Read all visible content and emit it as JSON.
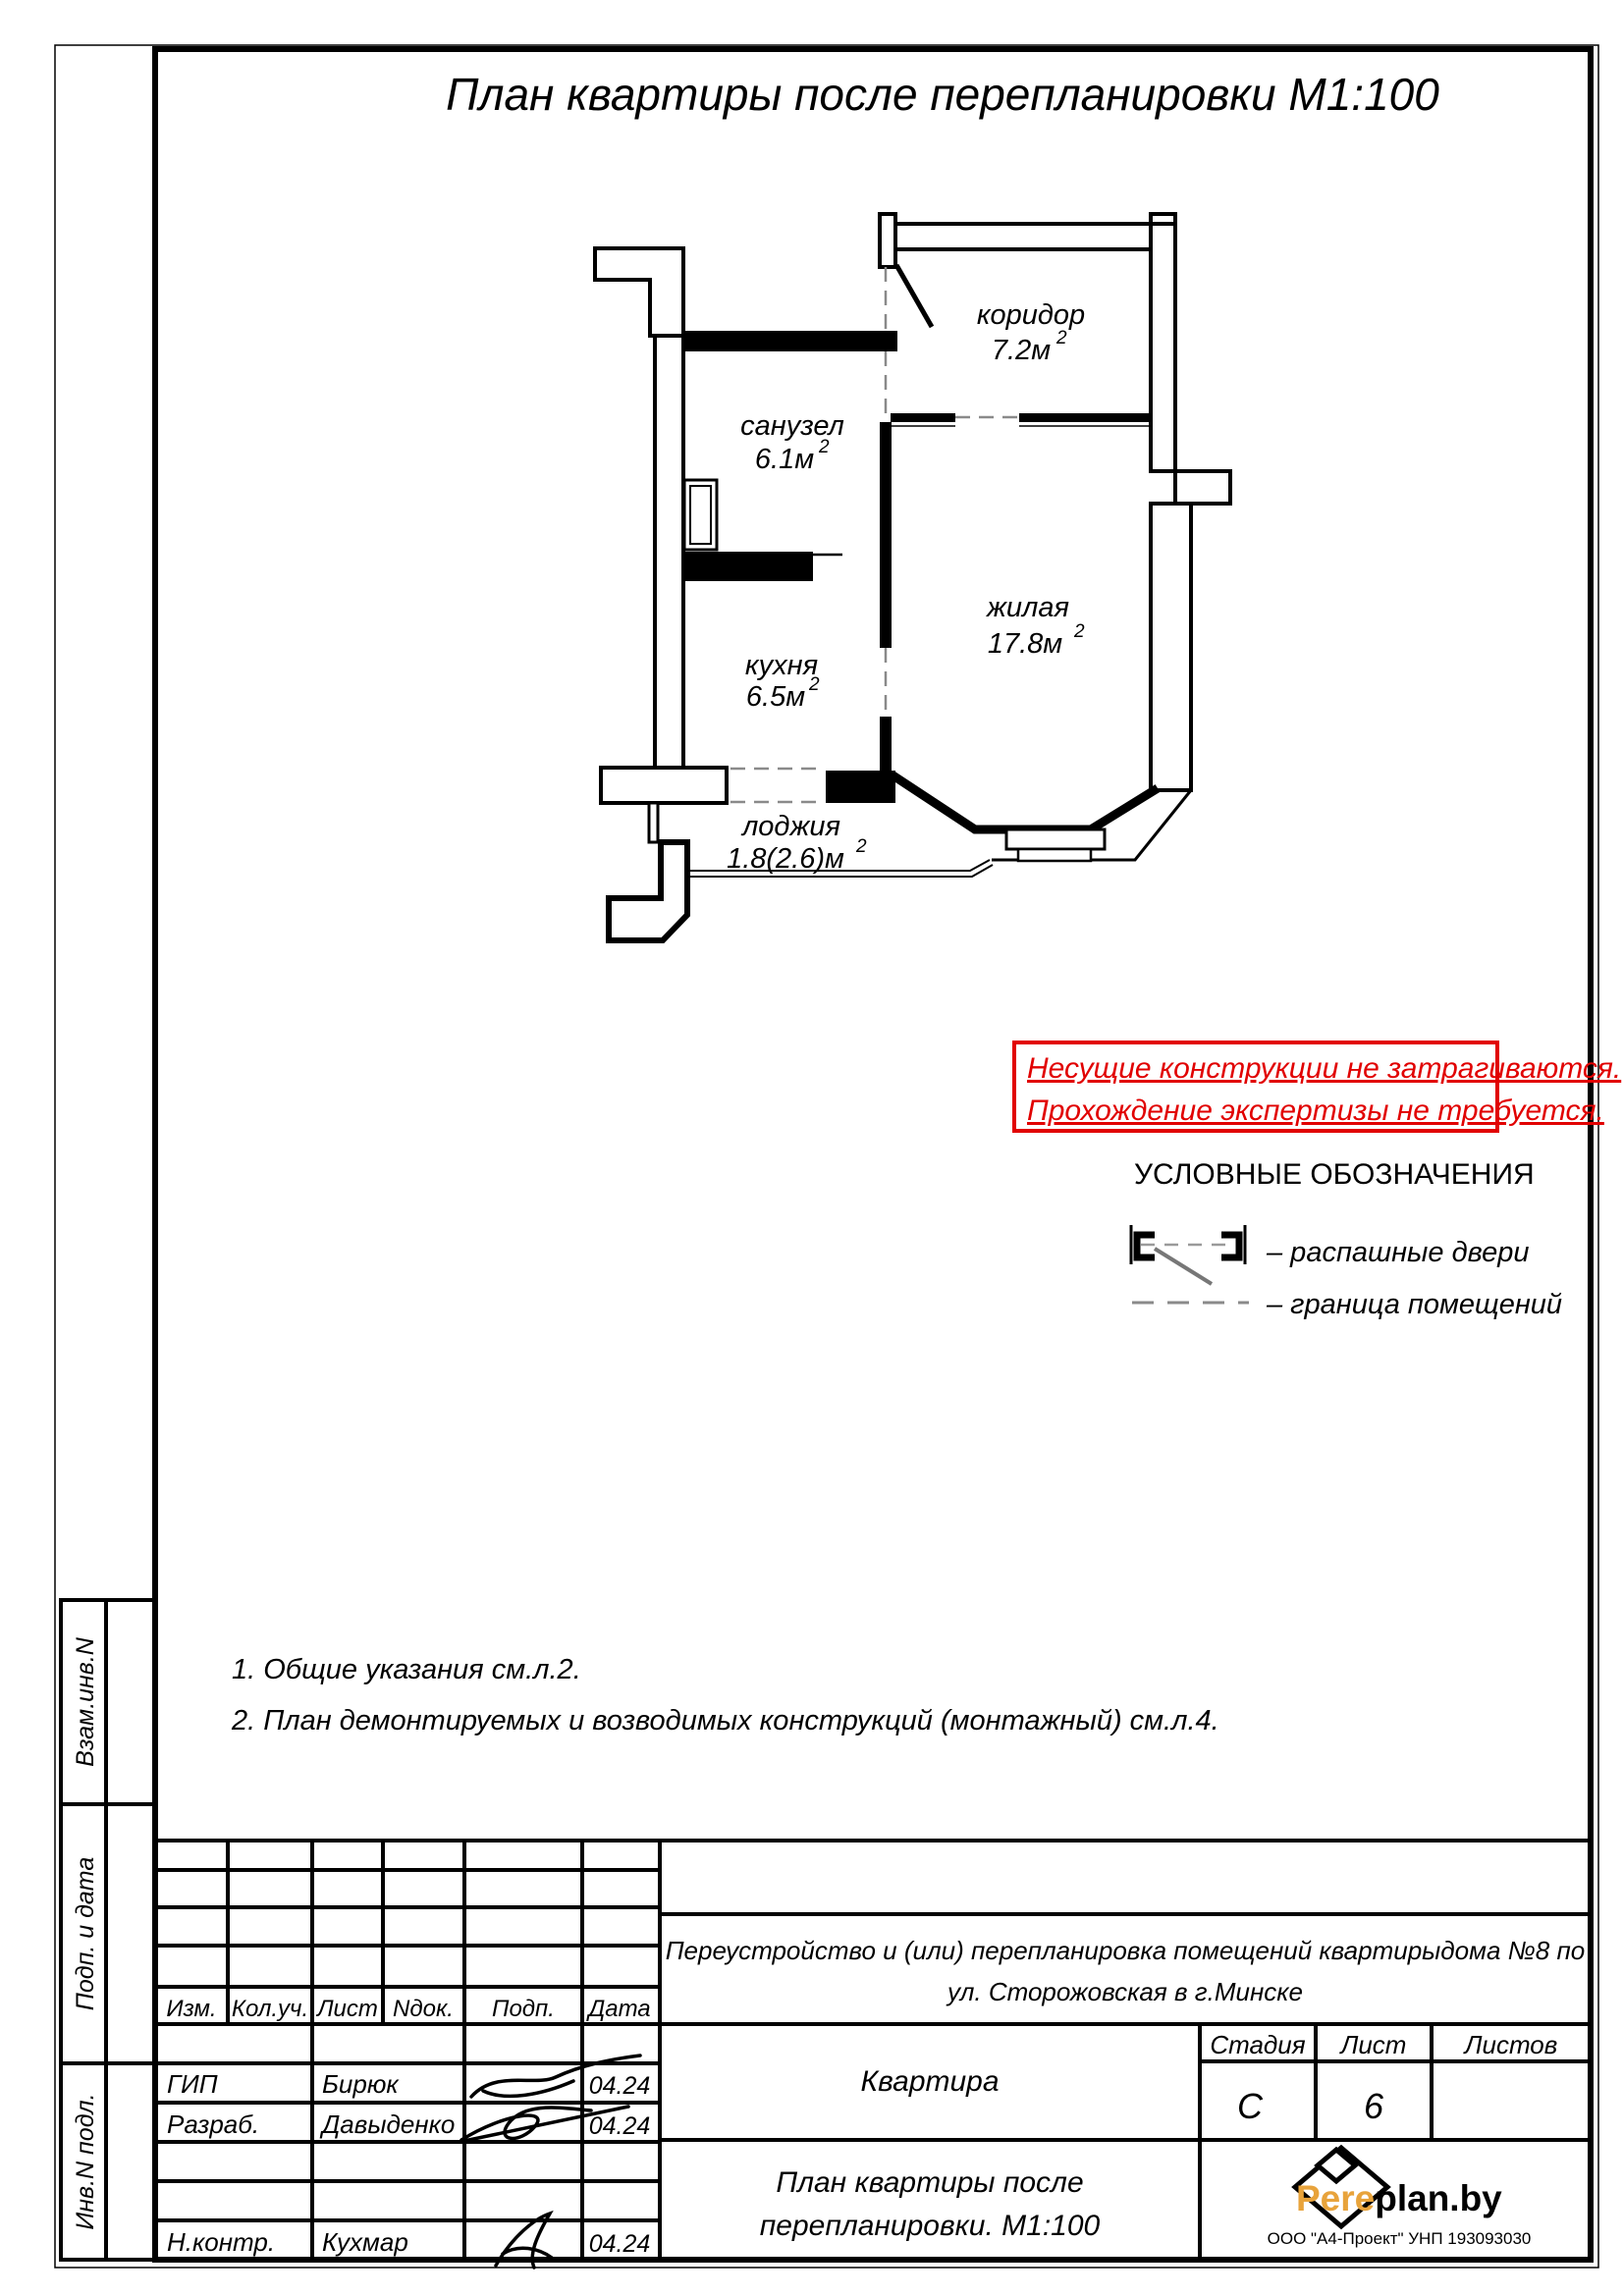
{
  "title": "План квартиры после перепланировки М1:100",
  "plan": {
    "rooms": [
      {
        "name": "коридор",
        "area": "7.2м",
        "sup": "2"
      },
      {
        "name": "санузел",
        "area": "6.1м",
        "sup": "2"
      },
      {
        "name": "жилая",
        "area": "17.8м",
        "sup": "2"
      },
      {
        "name": "кухня",
        "area": "6.5м",
        "sup": "2"
      },
      {
        "name": "лоджия",
        "area": "1.8(2.6)м",
        "sup": "2"
      }
    ]
  },
  "notice": {
    "line1": "Несущие конструкции не затрагиваются.",
    "line2": "Прохождение экспертизы не требуется.",
    "color": "#e10000"
  },
  "legend": {
    "heading": "УСЛОВНЫЕ ОБОЗНАЧЕНИЯ",
    "item_doors": "– распашные двери",
    "item_boundary": "– граница помещений"
  },
  "notes": {
    "n1": "1. Общие указания см.л.2.",
    "n2": "2. План демонтируемых и возводимых конструкций (монтажный) см.л.4."
  },
  "sidebar": {
    "s1": "Взам.инв.N",
    "s2": "Подп. и дата",
    "s3": "Инв.N подл."
  },
  "stamp": {
    "cols": {
      "izm": "Изм.",
      "koluch": "Кол.уч.",
      "list": "Лист",
      "ndok": "Nдок.",
      "podp": "Подп.",
      "data": "Дата"
    },
    "rows": {
      "r1": {
        "role": "ГИП",
        "name": "Бирюк",
        "date": "04.24"
      },
      "r2": {
        "role": "Разраб.",
        "name": "Давыденко",
        "date": "04.24"
      },
      "r3": {
        "role": "Н.контр.",
        "name": "Кухмар",
        "date": "04.24"
      }
    },
    "project_line1": "Переустройство и (или) перепланировка помещений квартирыдома №8 по",
    "project_line2": "ул. Сторожовская в г.Минске",
    "object": "Квартира",
    "stage_label": "Стадия",
    "sheet_label": "Лист",
    "sheets_label": "Листов",
    "stage": "С",
    "sheet": "6",
    "logo": {
      "part1": "Pere",
      "part2": "plan.by",
      "sub": "ООО \"А4-Проект\" УНП 193093030",
      "accent": "#E8A33B"
    },
    "doc_line1": "План квартиры после",
    "doc_line2": "перепланировки. М1:100"
  }
}
